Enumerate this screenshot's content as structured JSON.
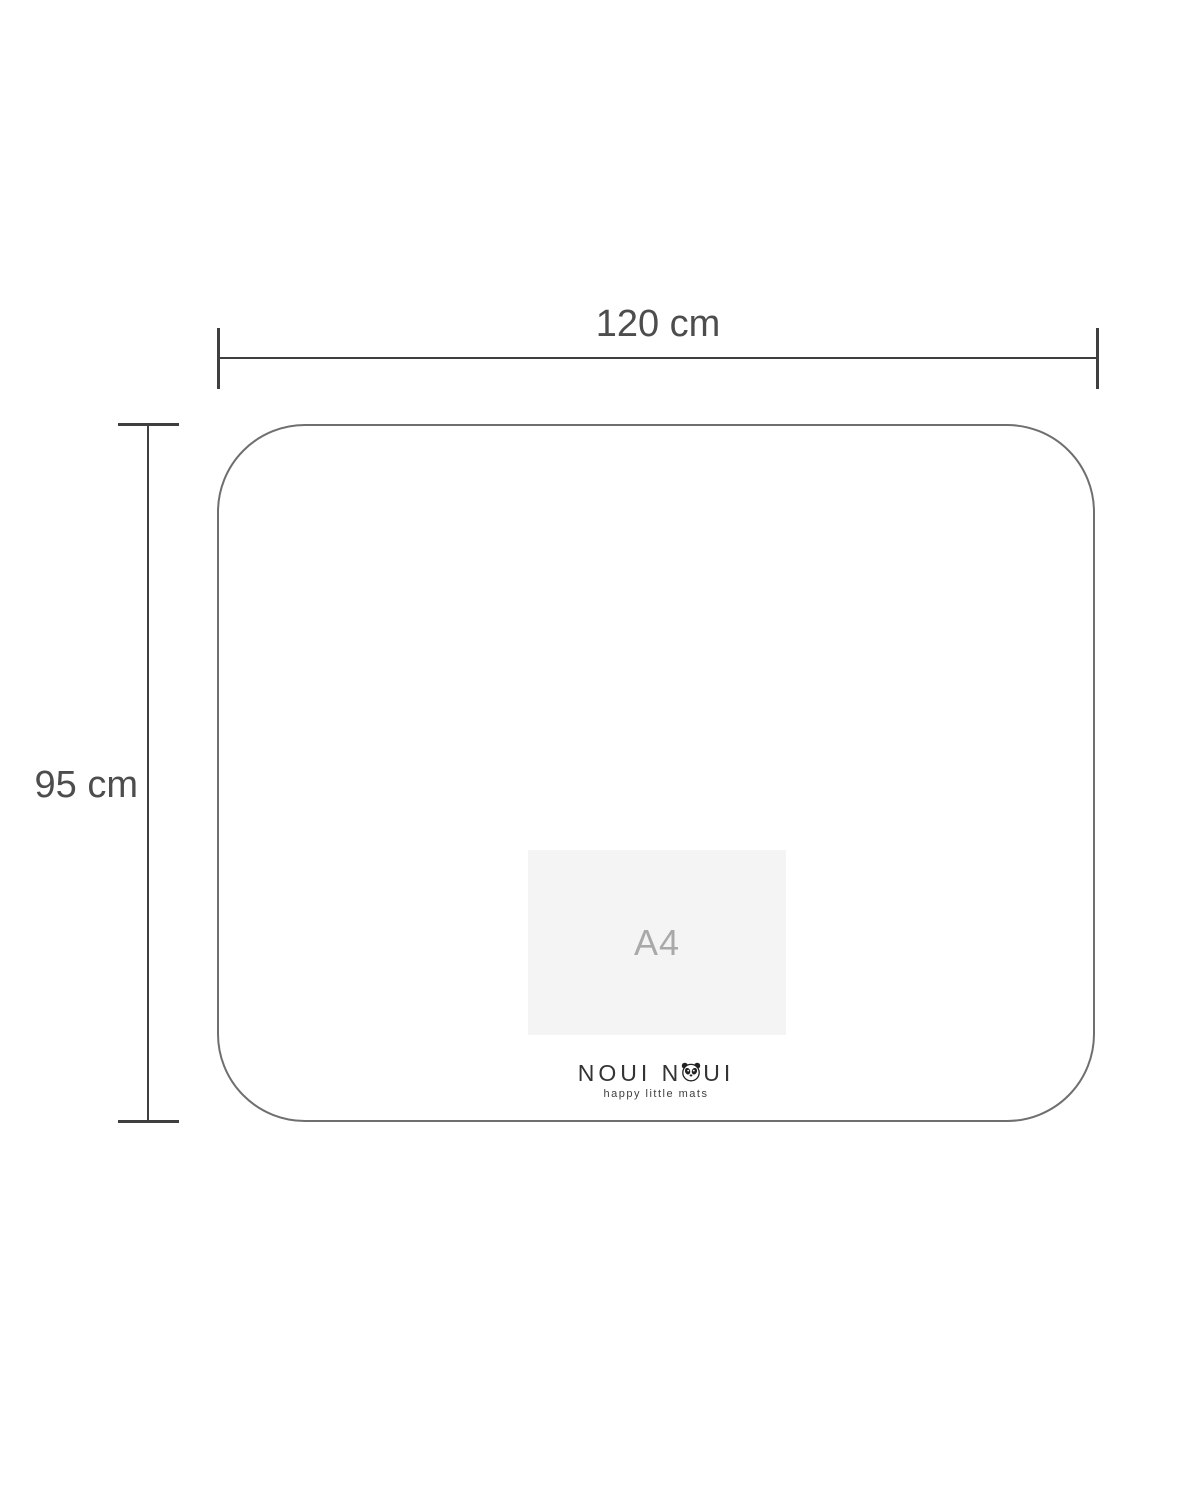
{
  "diagram": {
    "type": "product-dimension-diagram",
    "background": "#ffffff",
    "dimensions": {
      "width": {
        "label": "120 cm"
      },
      "height": {
        "label": "95 cm"
      }
    },
    "mat": {
      "outline_color": "#6f6f6f",
      "corner_style": "rounded"
    },
    "a4_reference": {
      "label": "A4",
      "fill": "#f4f4f4",
      "text_color": "#a9a9a9"
    },
    "brand": {
      "name_left": "NOUI N",
      "name_right": "UI",
      "full_name": "NOUI NOUI",
      "tagline": "happy little mats",
      "icon": "panda-face-icon",
      "text_color": "#333333"
    },
    "colors": {
      "dimension_line": "#3f3f3f",
      "label_text": "#4d4d4d"
    }
  }
}
